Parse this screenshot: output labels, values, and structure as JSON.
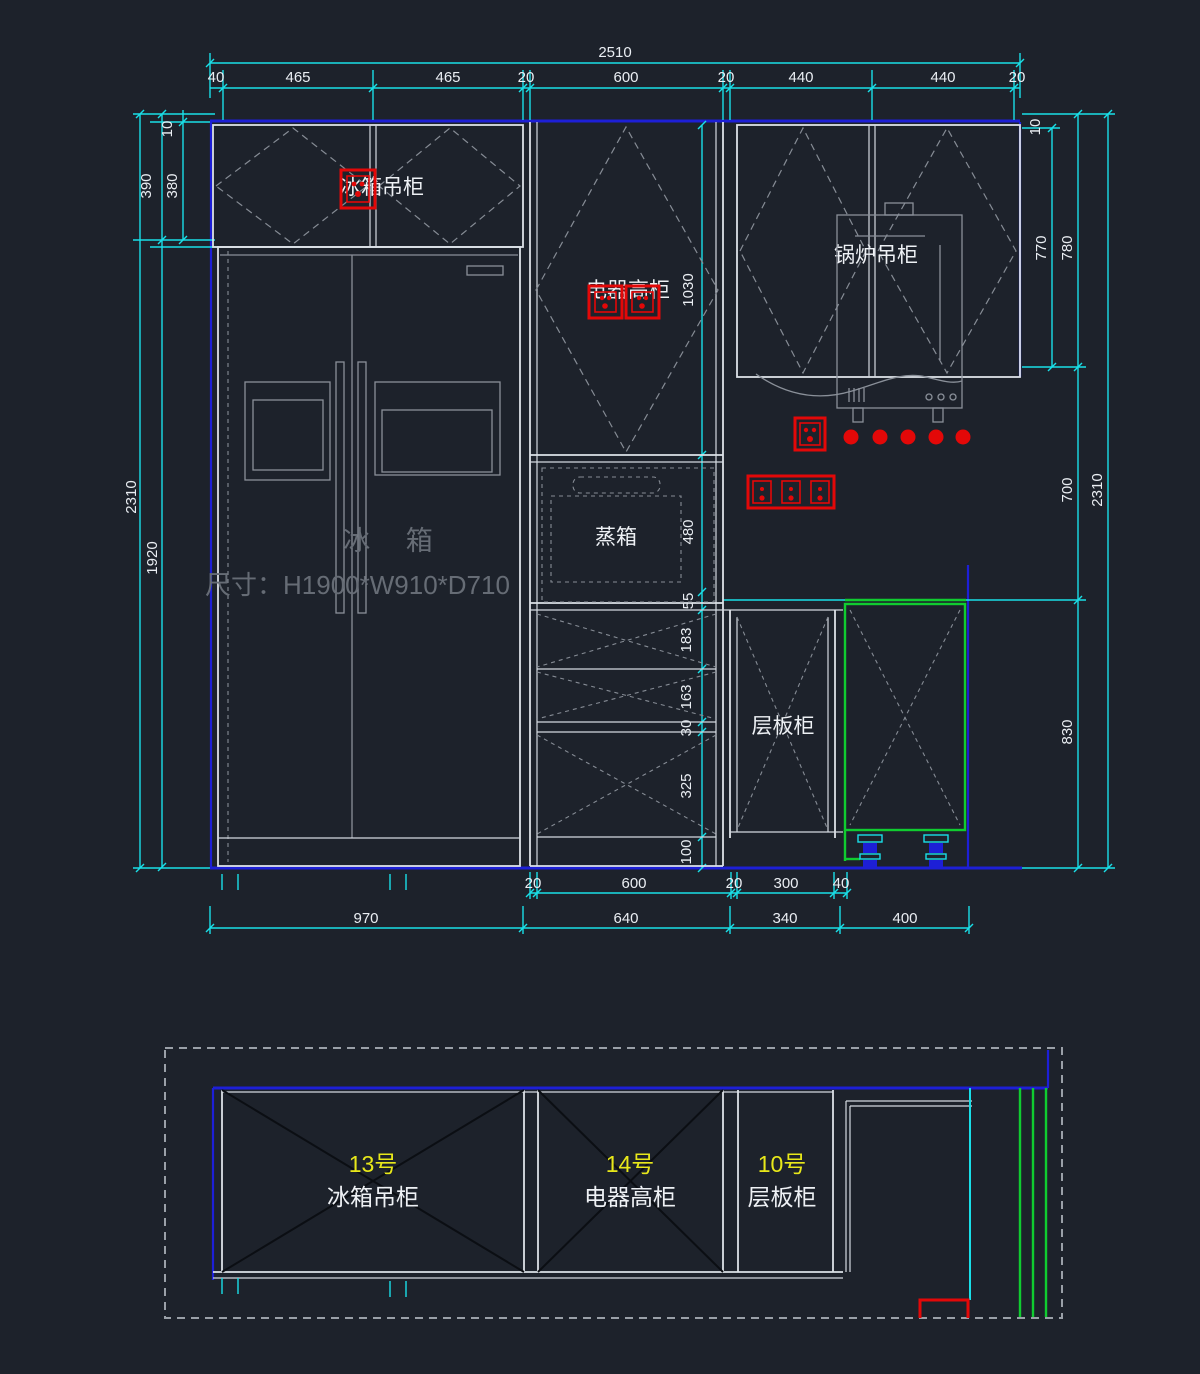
{
  "drawing": {
    "type": "CAD kitchen cabinet elevation and plan",
    "colors": {
      "background": "#1d222b",
      "dimension_line": "#19dfe8",
      "cabinet_line": "#dde2e8",
      "wall_line_blue": "#1d1fd6",
      "corner_cabinet_green": "#10cc30",
      "socket_red": "#e30808",
      "item_number_yellow": "#e8e81a"
    }
  },
  "elevation": {
    "top": {
      "total": "2510",
      "chain": [
        "40",
        "465",
        "465",
        "20",
        "600",
        "20",
        "440",
        "440",
        "20"
      ]
    },
    "left": {
      "gap": "10",
      "seg390": "390",
      "seg380": "380",
      "total": "2310",
      "fridge": "1920"
    },
    "right": {
      "gap": "10",
      "seg770": "770",
      "seg780": "780",
      "seg700": "700",
      "seg830": "830",
      "total": "2310"
    },
    "mid": {
      "tall": "1030",
      "steam": "480",
      "gap55": "55",
      "drawer1": "183",
      "drawer2": "163",
      "gap30": "30",
      "drawer3": "325",
      "plinth": "100"
    },
    "bottom": {
      "chain1": [
        "20",
        "600",
        "20",
        "300",
        "40"
      ],
      "chain2": [
        "970",
        "640",
        "340",
        "400"
      ]
    },
    "labels": {
      "fridge_wall_cabinet": "冰箱吊柜",
      "appliance_tall_cabinet": "电器高柜",
      "boiler_wall_cabinet": "锅炉吊柜",
      "steam_oven": "蒸箱",
      "shelf_cabinet": "层板柜",
      "fridge_name": "冰  箱",
      "fridge_size": "尺寸：H1900*W910*D710"
    }
  },
  "plan": {
    "items": [
      {
        "no": "13号",
        "name": "冰箱吊柜"
      },
      {
        "no": "14号",
        "name": "电器高柜"
      },
      {
        "no": "10号",
        "name": "层板柜"
      }
    ]
  }
}
